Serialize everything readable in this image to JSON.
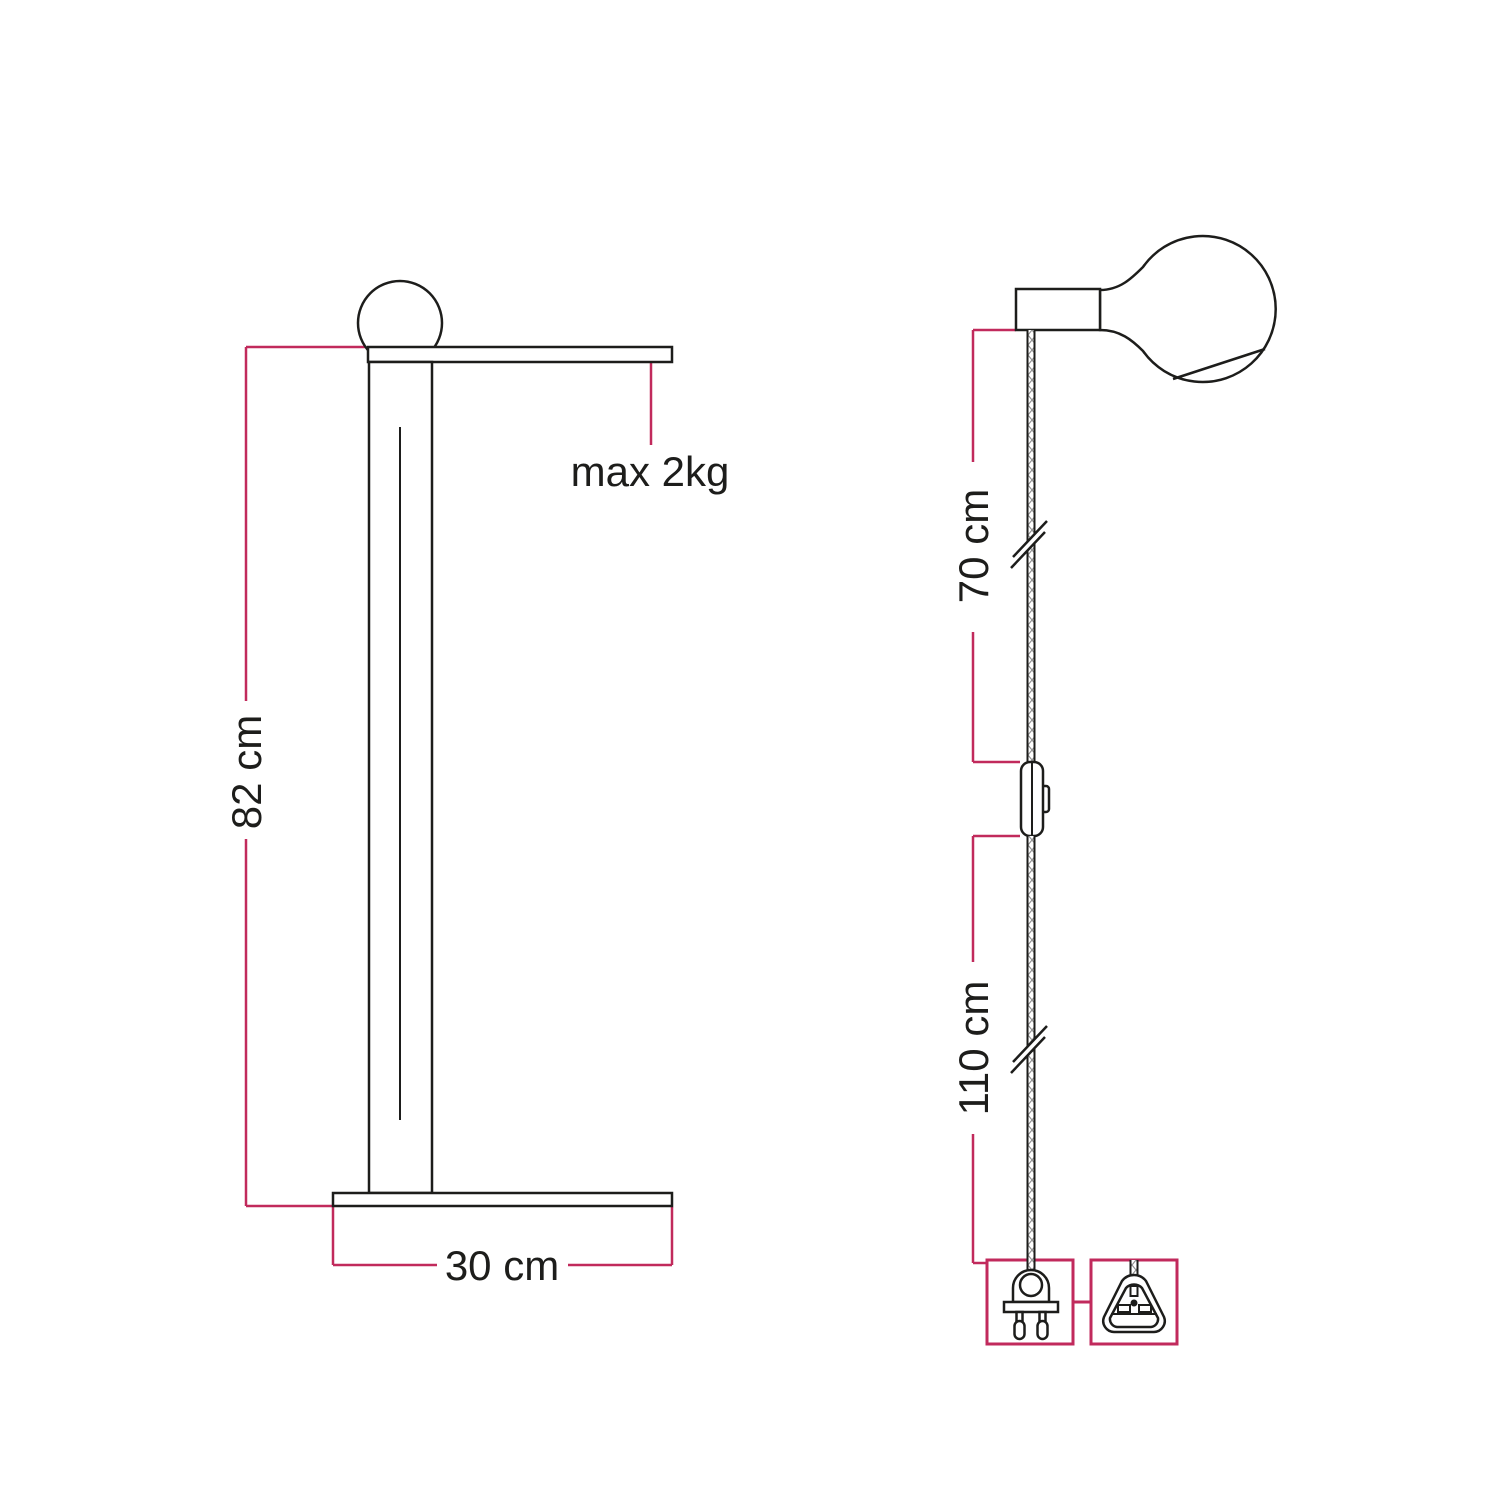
{
  "diagram": {
    "description": "Floor lamp technical dimension drawing with detachable power cable schematic",
    "colors": {
      "line": "#1d1d1b",
      "dimension": "#c12a5c",
      "braid": "#8f8f8f",
      "background": "#ffffff"
    },
    "lamp_view": {
      "name": "lamp-side-view",
      "height_label": "82 cm",
      "base_width_label": "30 cm",
      "max_load_label": "max 2kg",
      "parts": [
        "light-bulb-icon",
        "shelf-arm",
        "stem",
        "base-plate"
      ]
    },
    "cable_view": {
      "name": "cable-assembly-view",
      "upper_cable_label": "70 cm",
      "lower_cable_label": "110 cm",
      "parts": [
        "light-bulb-icon",
        "lamp-holder",
        "braided-cable",
        "inline-switch-icon",
        "eu-two-pin-plug-icon",
        "uk-three-pin-plug-icon"
      ]
    }
  }
}
